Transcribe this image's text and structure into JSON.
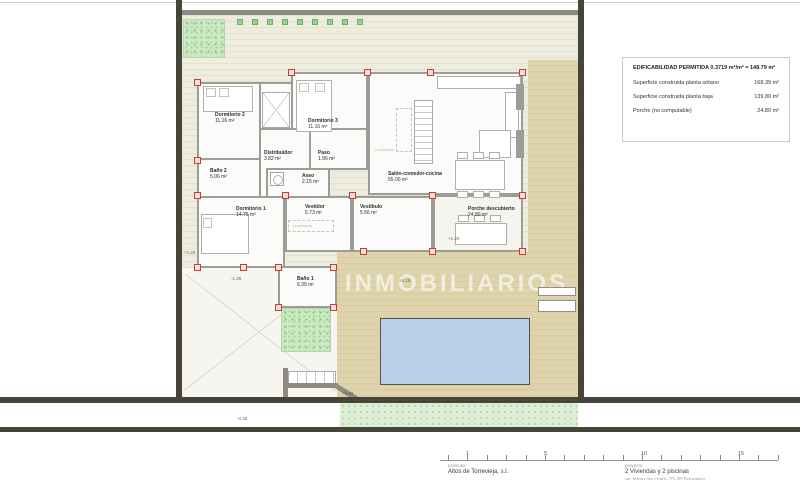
{
  "legend": {
    "title": "EDIFICABILIDAD PERMITIDA 0.3719 m²/m² = 148.79 m²",
    "rows": [
      {
        "label": "Superficie construida planta sótano",
        "value": "168.39 m²"
      },
      {
        "label": "Superficie construida planta baja",
        "value": "139.80 m²"
      },
      {
        "label": "Porche (no computable)",
        "value": "24.80 m²"
      }
    ]
  },
  "rooms": {
    "dormitorio2": {
      "name": "Dormitorio 2",
      "area": "11.16 m²"
    },
    "dormitorio3": {
      "name": "Dormitorio 3",
      "area": "11.16 m²"
    },
    "distribuidor": {
      "name": "Distribuidor",
      "area": "3.82 m²"
    },
    "paso": {
      "name": "Paso",
      "area": "1.96 m²"
    },
    "bano2": {
      "name": "Baño 2",
      "area": "5.06 m²"
    },
    "aseo": {
      "name": "Aseo",
      "area": "2.15 m²"
    },
    "salon": {
      "name": "Salón-comedor-cocina",
      "area": "55.00 m²"
    },
    "dormitorio1": {
      "name": "Dormitorio 1",
      "area": "14.75 m²"
    },
    "vestidor": {
      "name": "Vestidor",
      "area": "5.73 m²"
    },
    "vestibulo": {
      "name": "Vestíbulo",
      "area": "5.56 m²"
    },
    "porche": {
      "name": "Porche descubierto",
      "area": "24.80 m²"
    },
    "bano1": {
      "name": "Baño 1",
      "area": "6.39 m²"
    }
  },
  "annotations": {
    "lucernario_salon": "Lucernario",
    "lucernario_vestidor": "Lucernario",
    "levels": {
      "left": "+1.20",
      "porche": "+1.20",
      "terraza": "+1.15",
      "steps": "+0.58",
      "acera": "-0.38",
      "rampa": "-1.28"
    }
  },
  "watermark": "INMOBILIARIOS",
  "titleblock": {
    "scale_numbers": [
      "1",
      "5",
      "10",
      "15"
    ],
    "promotor_label": "promotor",
    "promotor_value": "Altos de Torrevieja, s.l.",
    "proyecto_label": "proyecto",
    "proyecto_value": "2 Viviendas y 2 piscinas",
    "proyecto_address": "av. lomas ba costa, 23-28 Torrevieja"
  }
}
